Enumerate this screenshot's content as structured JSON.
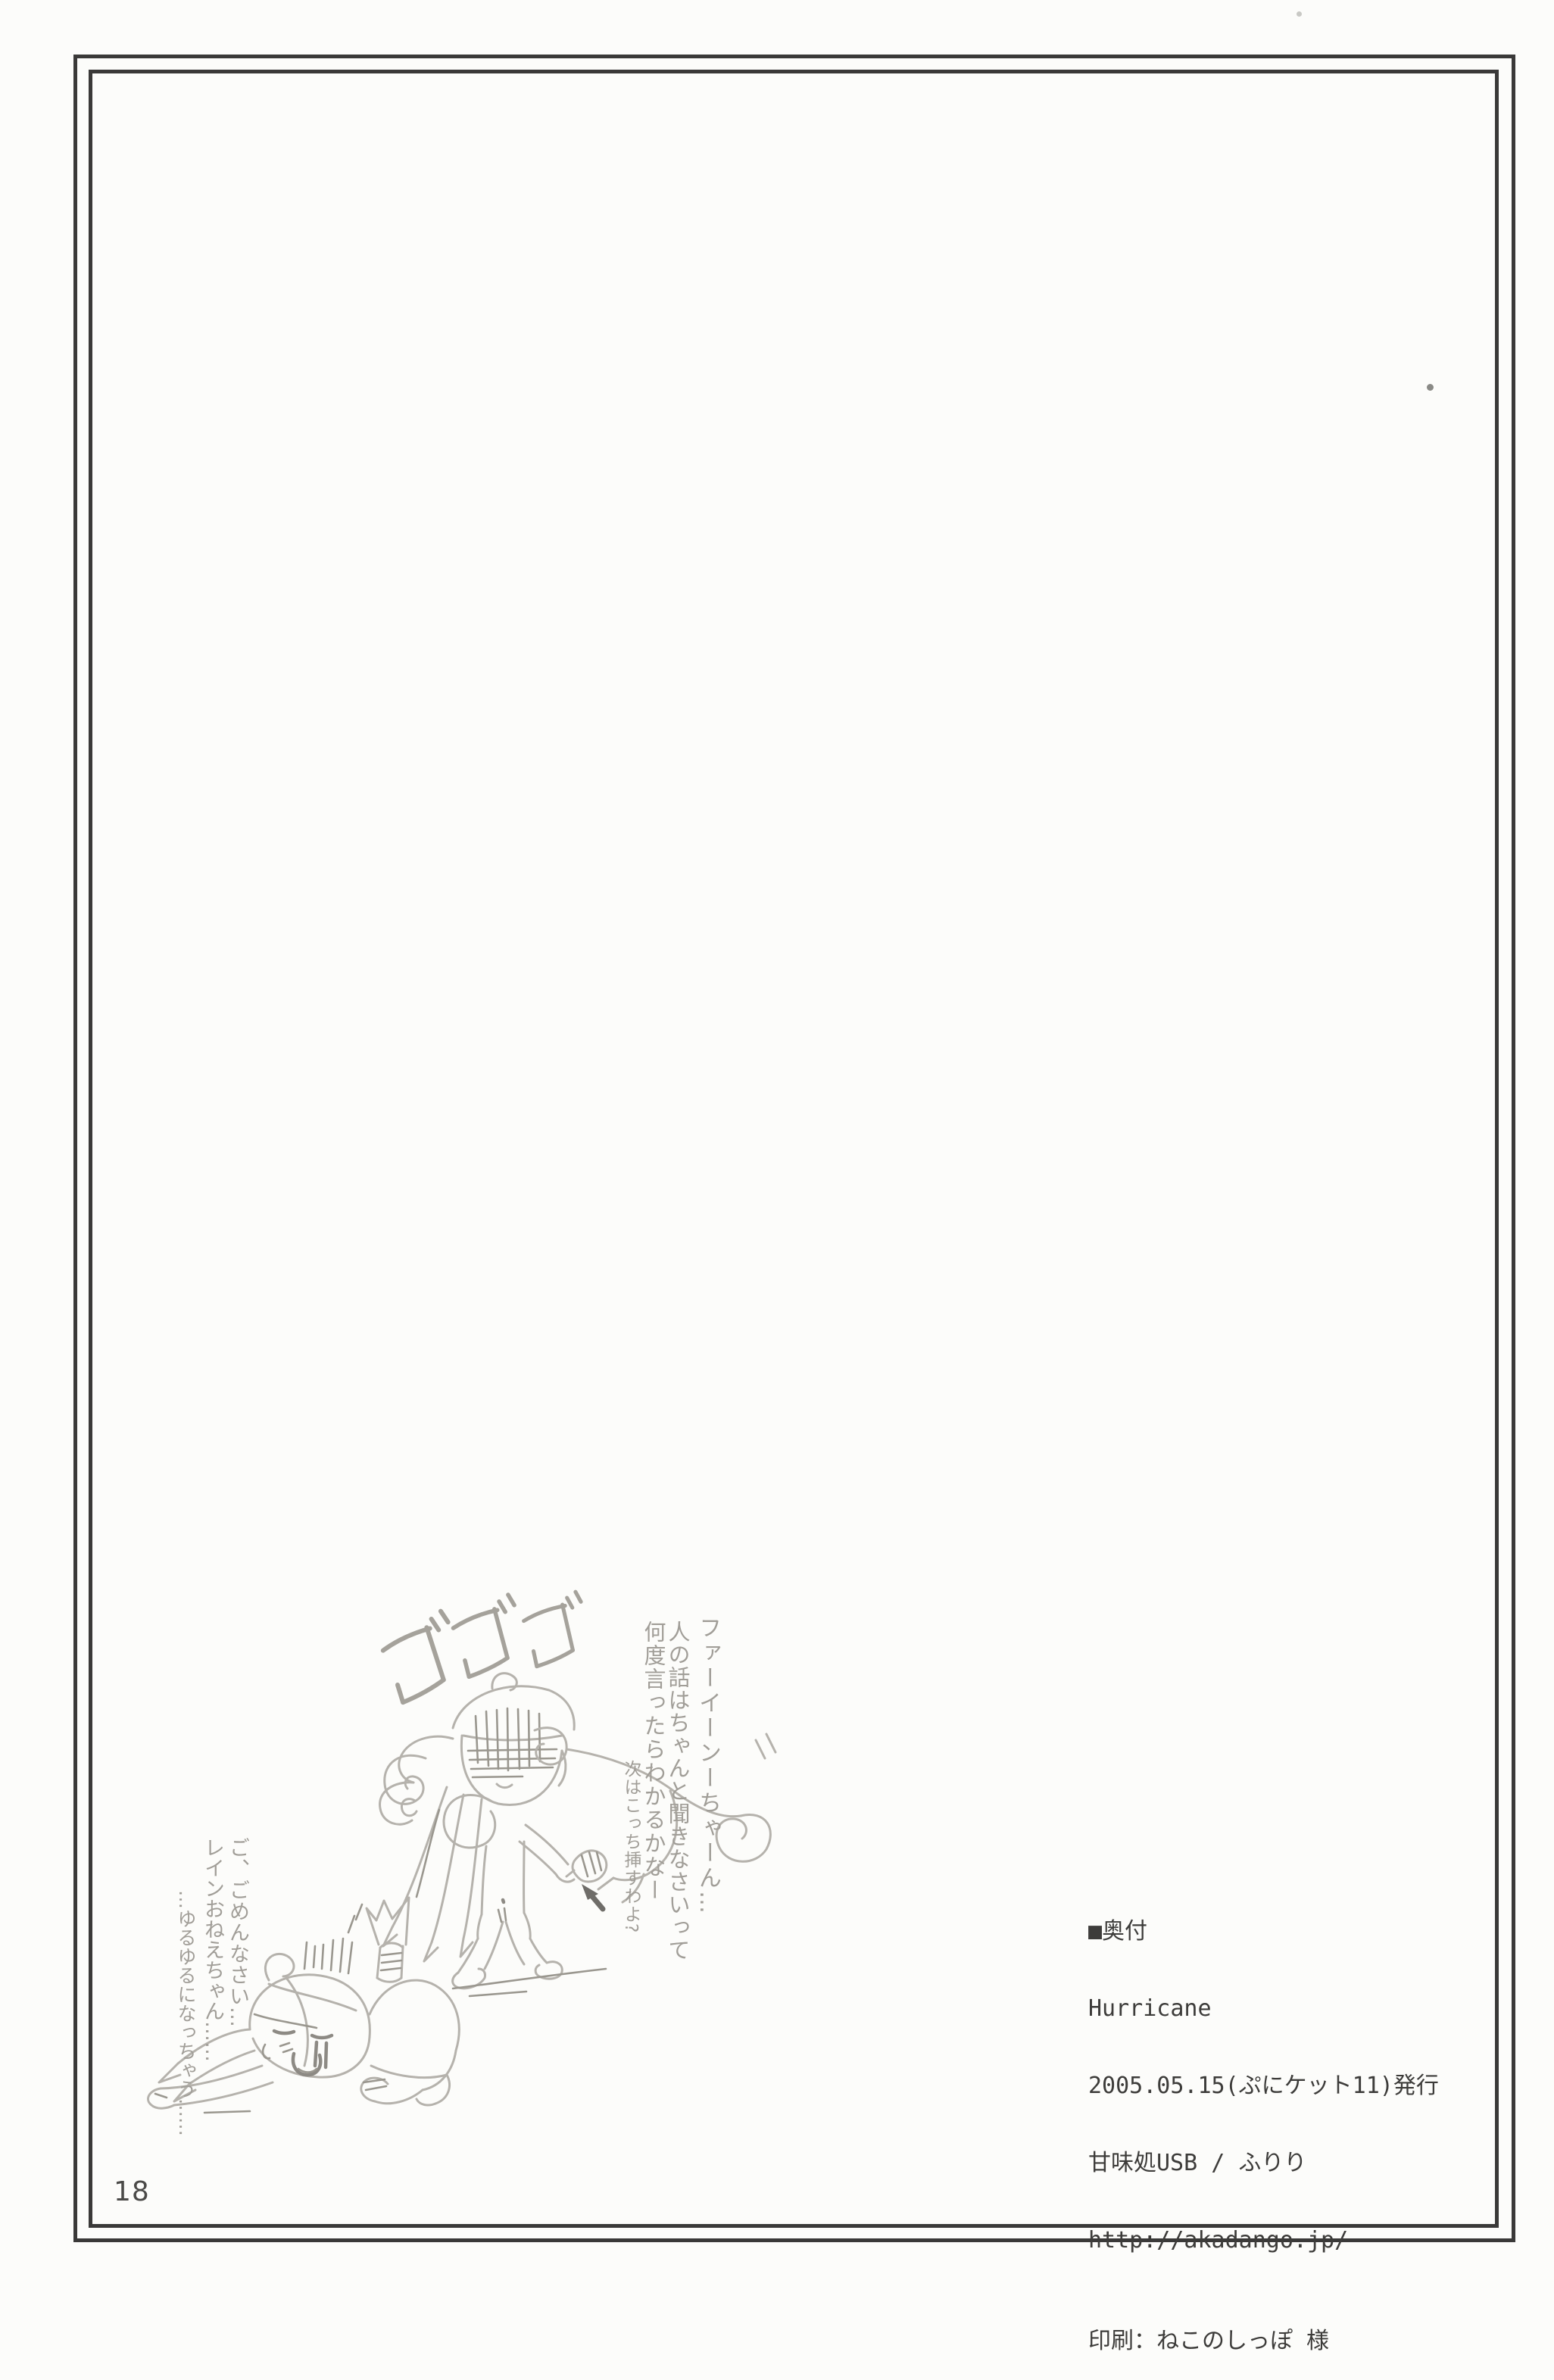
{
  "page": {
    "page_number": "18",
    "paper_color": "#fcfcfa",
    "frame_color": "#3a3938"
  },
  "colophon": {
    "heading": "■奥付",
    "title": "Hurricane",
    "published": "2005.05.15(ぷにケット11)発行",
    "circle": "甘味処USB / ふりり",
    "url": "http://akadango.jp/",
    "printer": "印刷：ねこのしっぽ 様",
    "ink_color": "#3d3c3a"
  },
  "sketch": {
    "sfx": "ゴゴゴ",
    "pencil_color": "#b5b2ac",
    "speech_right": [
      "ファーイーンーちゃーん…",
      "人の話はちゃんと聞きなさいって",
      "何度言ったらわかるかなー"
    ],
    "speech_right_small": "次はこっち挿すわよ?",
    "speech_left": [
      "ご、ごめんなさい…",
      "レインおねえちゃん……",
      "…ゆるゆるになっちゃう……"
    ]
  }
}
